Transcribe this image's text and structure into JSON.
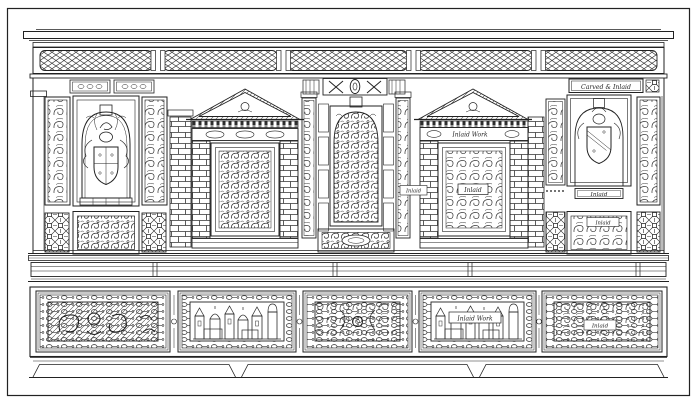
{
  "plate": {
    "description": "Engraved plate of a carved and inlaid Renaissance sideboard front",
    "ink_color": "#222222",
    "paper_color": "#ffffff"
  },
  "labels": {
    "top_right": "Carved & Inlaid",
    "frieze_inlaid_work": "Inlaid Work",
    "panel_inlaid": "Inlaid",
    "jamb_inlaid": "Inlaid",
    "right_bar_inlaid": "Inlaid",
    "right_lower_inlaid": "Inlaid",
    "bottom_inlaid_work": "Inlaid Work",
    "bottom_inlaid": "Inlaid"
  }
}
